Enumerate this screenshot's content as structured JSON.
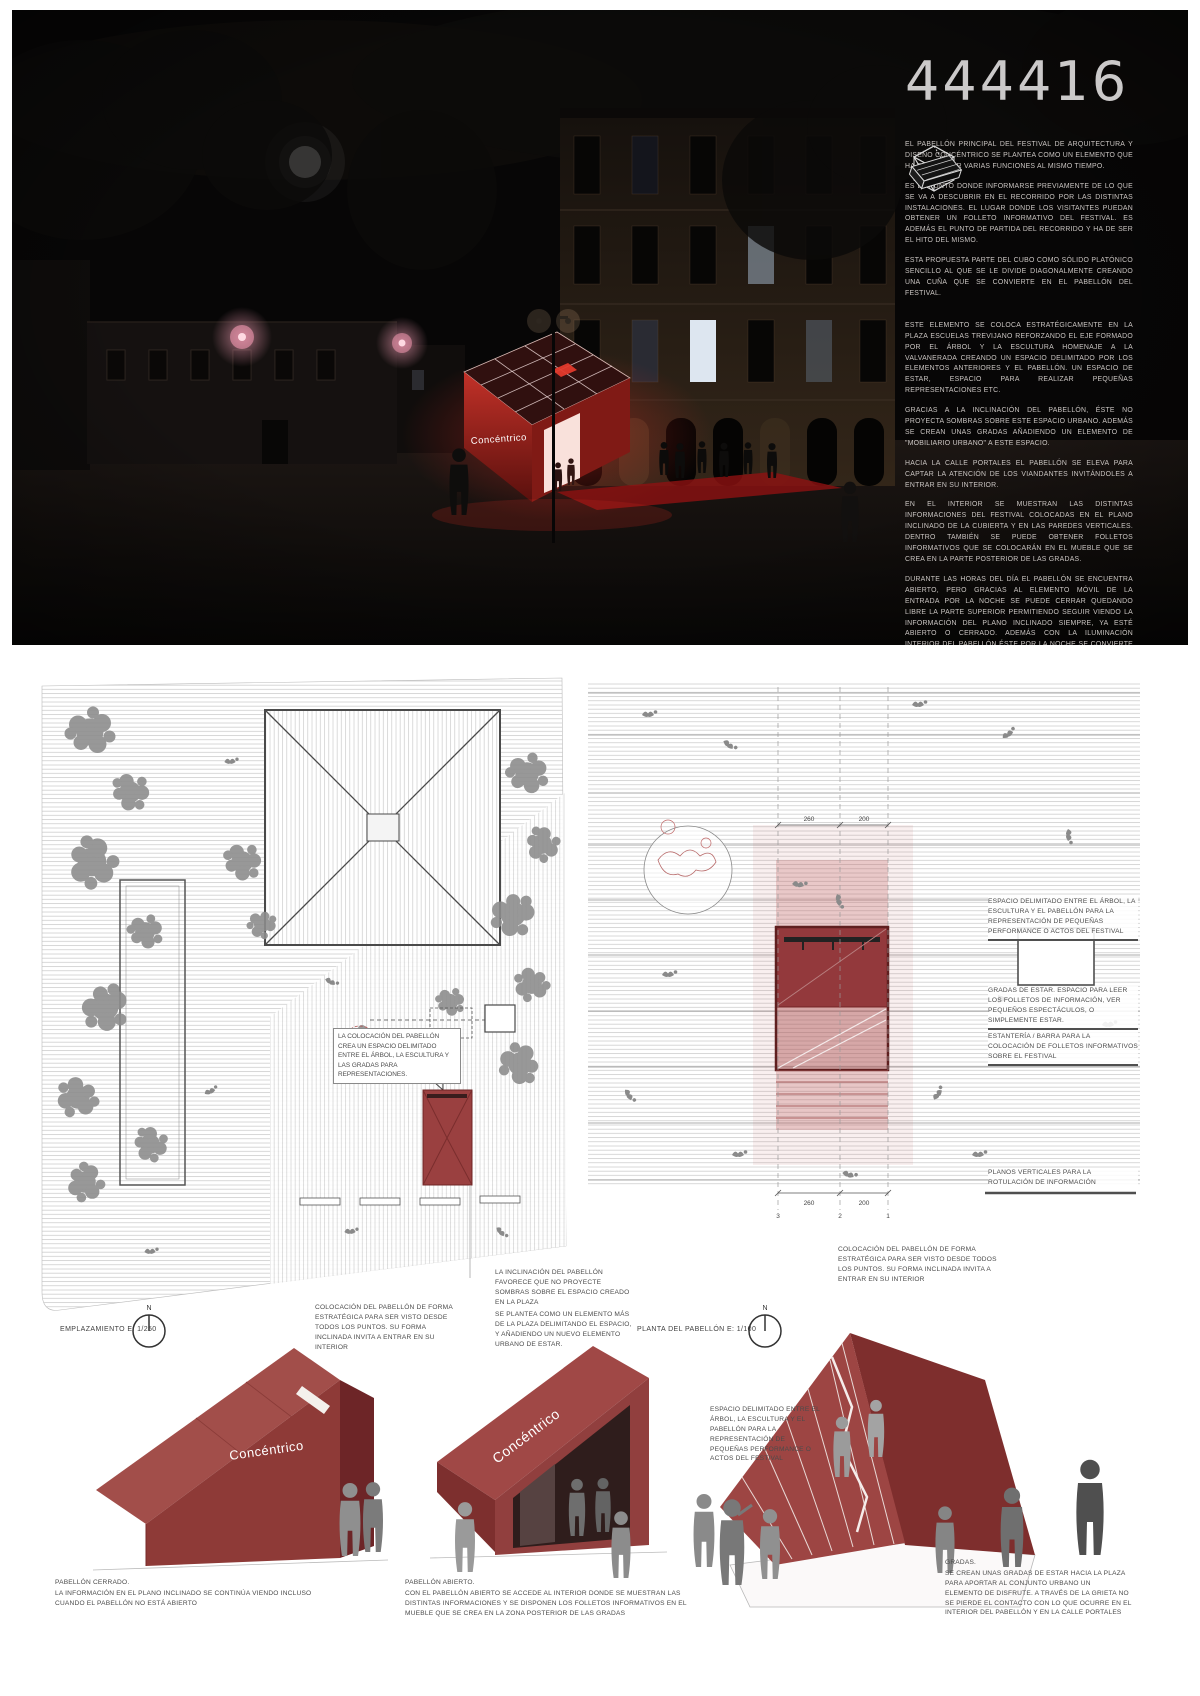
{
  "board": {
    "number": "444416",
    "brand": "Concéntrico"
  },
  "colors": {
    "pavilion_red": "#9d4543",
    "pavilion_red_dark": "#7c2c2c",
    "night_bg": "#070606",
    "lamp_pink": "#ff9db5",
    "annotation_gray": "#4b4b4b"
  },
  "hero": {
    "paragraphs": [
      "EL PABELLÓN PRINCIPAL DEL FESTIVAL DE ARQUITECTURA Y DISEÑO CONCÉNTRICO SE PLANTEA COMO UN ELEMENTO QUE HA DE CUMPLIR VARIAS FUNCIONES AL MISMO TIEMPO.",
      "ES EL PUNTO DONDE INFORMARSE PREVIAMENTE DE LO QUE SE VA A DESCUBRIR EN EL RECORRIDO POR LAS DISTINTAS INSTALACIONES. EL LUGAR DONDE LOS VISITANTES PUEDAN OBTENER UN FOLLETO INFORMATIVO DEL FESTIVAL. ES ADEMÁS EL PUNTO DE PARTIDA DEL RECORRIDO Y HA DE SER EL HITO DEL MISMO.",
      "ESTA PROPUESTA PARTE DEL CUBO COMO SÓLIDO PLATÓNICO SENCILLO AL QUE SE LE DIVIDE DIAGONALMENTE CREANDO UNA CUÑA QUE SE CONVIERTE EN EL PABELLÓN DEL FESTIVAL.",
      "ESTE ELEMENTO SE COLOCA ESTRATÉGICAMENTE EN LA PLAZA ESCUELAS TREVIJANO REFORZANDO EL EJE FORMADO POR EL ÁRBOL Y LA ESCULTURA HOMENAJE A LA VALVANERADA CREANDO UN ESPACIO DELIMITADO POR LOS ELEMENTOS ANTERIORES Y EL PABELLÓN. UN ESPACIO DE ESTAR, ESPACIO PARA REALIZAR PEQUEÑAS REPRESENTACIONES ETC.",
      "GRACIAS A LA INCLINACIÓN DEL PABELLÓN, ÉSTE NO PROYECTA SOMBRAS SOBRE ESTE ESPACIO URBANO. ADEMÁS SE CREAN UNAS GRADAS AÑADIENDO UN ELEMENTO DE \"MOBILIARIO URBANO\" A ESTE ESPACIO.",
      "HACIA LA CALLE PORTALES EL PABELLÓN SE ELEVA PARA CAPTAR LA ATENCIÓN DE LOS VIANDANTES INVITÁNDOLES A ENTRAR EN SU INTERIOR.",
      "EN EL INTERIOR SE MUESTRAN LAS DISTINTAS INFORMACIONES DEL FESTIVAL COLOCADAS EN EL PLANO INCLINADO DE LA CUBIERTA Y EN LAS PAREDES VERTICALES. DENTRO TAMBIÉN SE PUEDE OBTENER FOLLETOS INFORMATIVOS QUE SE COLOCARÁN EN EL MUEBLE QUE SE CREA EN LA PARTE POSTERIOR DE LAS GRADAS.",
      "DURANTE LAS HORAS DEL DÍA EL PABELLÓN SE ENCUENTRA ABIERTO, PERO GRACIAS AL ELEMENTO MÓVIL DE LA ENTRADA POR LA NOCHE SE PUEDE CERRAR QUEDANDO LIBRE LA PARTE SUPERIOR PERMITIENDO SEGUIR VIENDO LA INFORMACIÓN DEL PLANO INCLINADO SIEMPRE, YA ESTÉ ABIERTO O CERRADO. ADEMÁS CON LA ILUMINACIÓN INTERIOR DEL PABELLÓN ÉSTE POR LA NOCHE SE CONVIERTE EN UNA LÁMPARA HACIA LA CALLE PORTALES Y HACIA LA PLAZA."
    ],
    "concept_icons": [
      "cubo sólido",
      "cubo dividido diagonalmente",
      "cuña extraída"
    ]
  },
  "siteplan": {
    "label": "EMPLAZAMIENTO E: 1/250",
    "north": "N",
    "note": "LA COLOCACIÓN DEL PABELLÓN CREA UN ESPACIO DELIMITADO ENTRE EL ÁRBOL, LA ESCULTURA Y LAS GRADAS PARA REPRESENTACIONES.",
    "caption_left": "COLOCACIÓN DEL PABELLÓN DE FORMA ESTRATÉGICA PARA SER VISTO DESDE TODOS LOS PUNTOS. SU FORMA INCLINADA INVITA A ENTRAR EN SU INTERIOR",
    "caption_right_1": "LA INCLINACIÓN DEL PABELLÓN FAVORECE QUE NO PROYECTE SOMBRAS SOBRE EL ESPACIO CREADO EN LA PLAZA",
    "caption_right_2": "SE PLANTEA COMO UN ELEMENTO MÁS DE LA PLAZA DELIMITANDO EL ESPACIO, Y AÑADIENDO UN NUEVO ELEMENTO URBANO DE ESTAR."
  },
  "floorplan": {
    "label": "PLANTA DEL PABELLÓN E: 1/100",
    "north": "N",
    "annotations": [
      "ESPACIO DELIMITADO ENTRE EL ÁRBOL, LA ESCULTURA Y EL PABELLÓN PARA LA REPRESENTACIÓN DE PEQUEÑAS PERFORMANCE O ACTOS DEL FESTIVAL",
      "GRADAS DE ESTAR. ESPACIO PARA LEER LOS FOLLETOS DE INFORMACIÓN, VER PEQUEÑOS ESPECTÁCULOS, O SIMPLEMENTE ESTAR.",
      "ESTANTERÍA / BARRA PARA LA COLOCACIÓN DE FOLLETOS INFORMATIVOS SOBRE EL FESTIVAL",
      "PLANOS VERTICALES PARA LA ROTULACIÓN DE INFORMACIÓN"
    ],
    "caption": "COLOCACIÓN DEL PABELLÓN DE FORMA ESTRATÉGICA PARA SER VISTO DESDE TODOS LOS PUNTOS. SU FORMA INCLINADA INVITA A ENTRAR EN SU INTERIOR",
    "dims_top": [
      "260",
      "200"
    ],
    "dims_bottom": [
      "260",
      "200"
    ],
    "grid": [
      "3",
      "2",
      "1"
    ]
  },
  "axos": {
    "closed": {
      "title": "PABELLÓN CERRADO.",
      "body": "LA INFORMACIÓN EN EL PLANO INCLINADO SE CONTINÚA VIENDO INCLUSO\nCUANDO EL PABELLÓN NO ESTÁ ABIERTO"
    },
    "open": {
      "title": "PABELLÓN ABIERTO.",
      "body": "CON EL PABELLÓN ABIERTO SE ACCEDE AL INTERIOR DONDE SE MUESTRAN LAS\nDISTINTAS INFORMACIONES Y SE DISPONEN LOS FOLLETOS INFORMATIVOS EN EL\nMUEBLE QUE SE CREA EN LA ZONA POSTERIOR DE LAS GRADAS"
    },
    "gradas_note": "ESPACIO DELIMITADO ENTRE EL ÁRBOL, LA ESCULTURA Y EL PABELLÓN PARA LA REPRESENTACIÓN DE PEQUEÑAS PERFORMANCE O ACTOS DEL FESTIVAL",
    "gradas": {
      "title": "GRADAS.",
      "body": "SE CREAN UNAS GRADAS DE ESTAR HACIA LA PLAZA\nPARA APORTAR AL CONJUNTO URBANO UN\nELEMENTO DE DISFRUTE. A TRAVÉS DE LA GRIETA NO\nSE PIERDE EL CONTACTO CON LO QUE OCURRE EN EL\nINTERIOR DEL PABELLÓN Y EN LA CALLE PORTALES"
    }
  }
}
